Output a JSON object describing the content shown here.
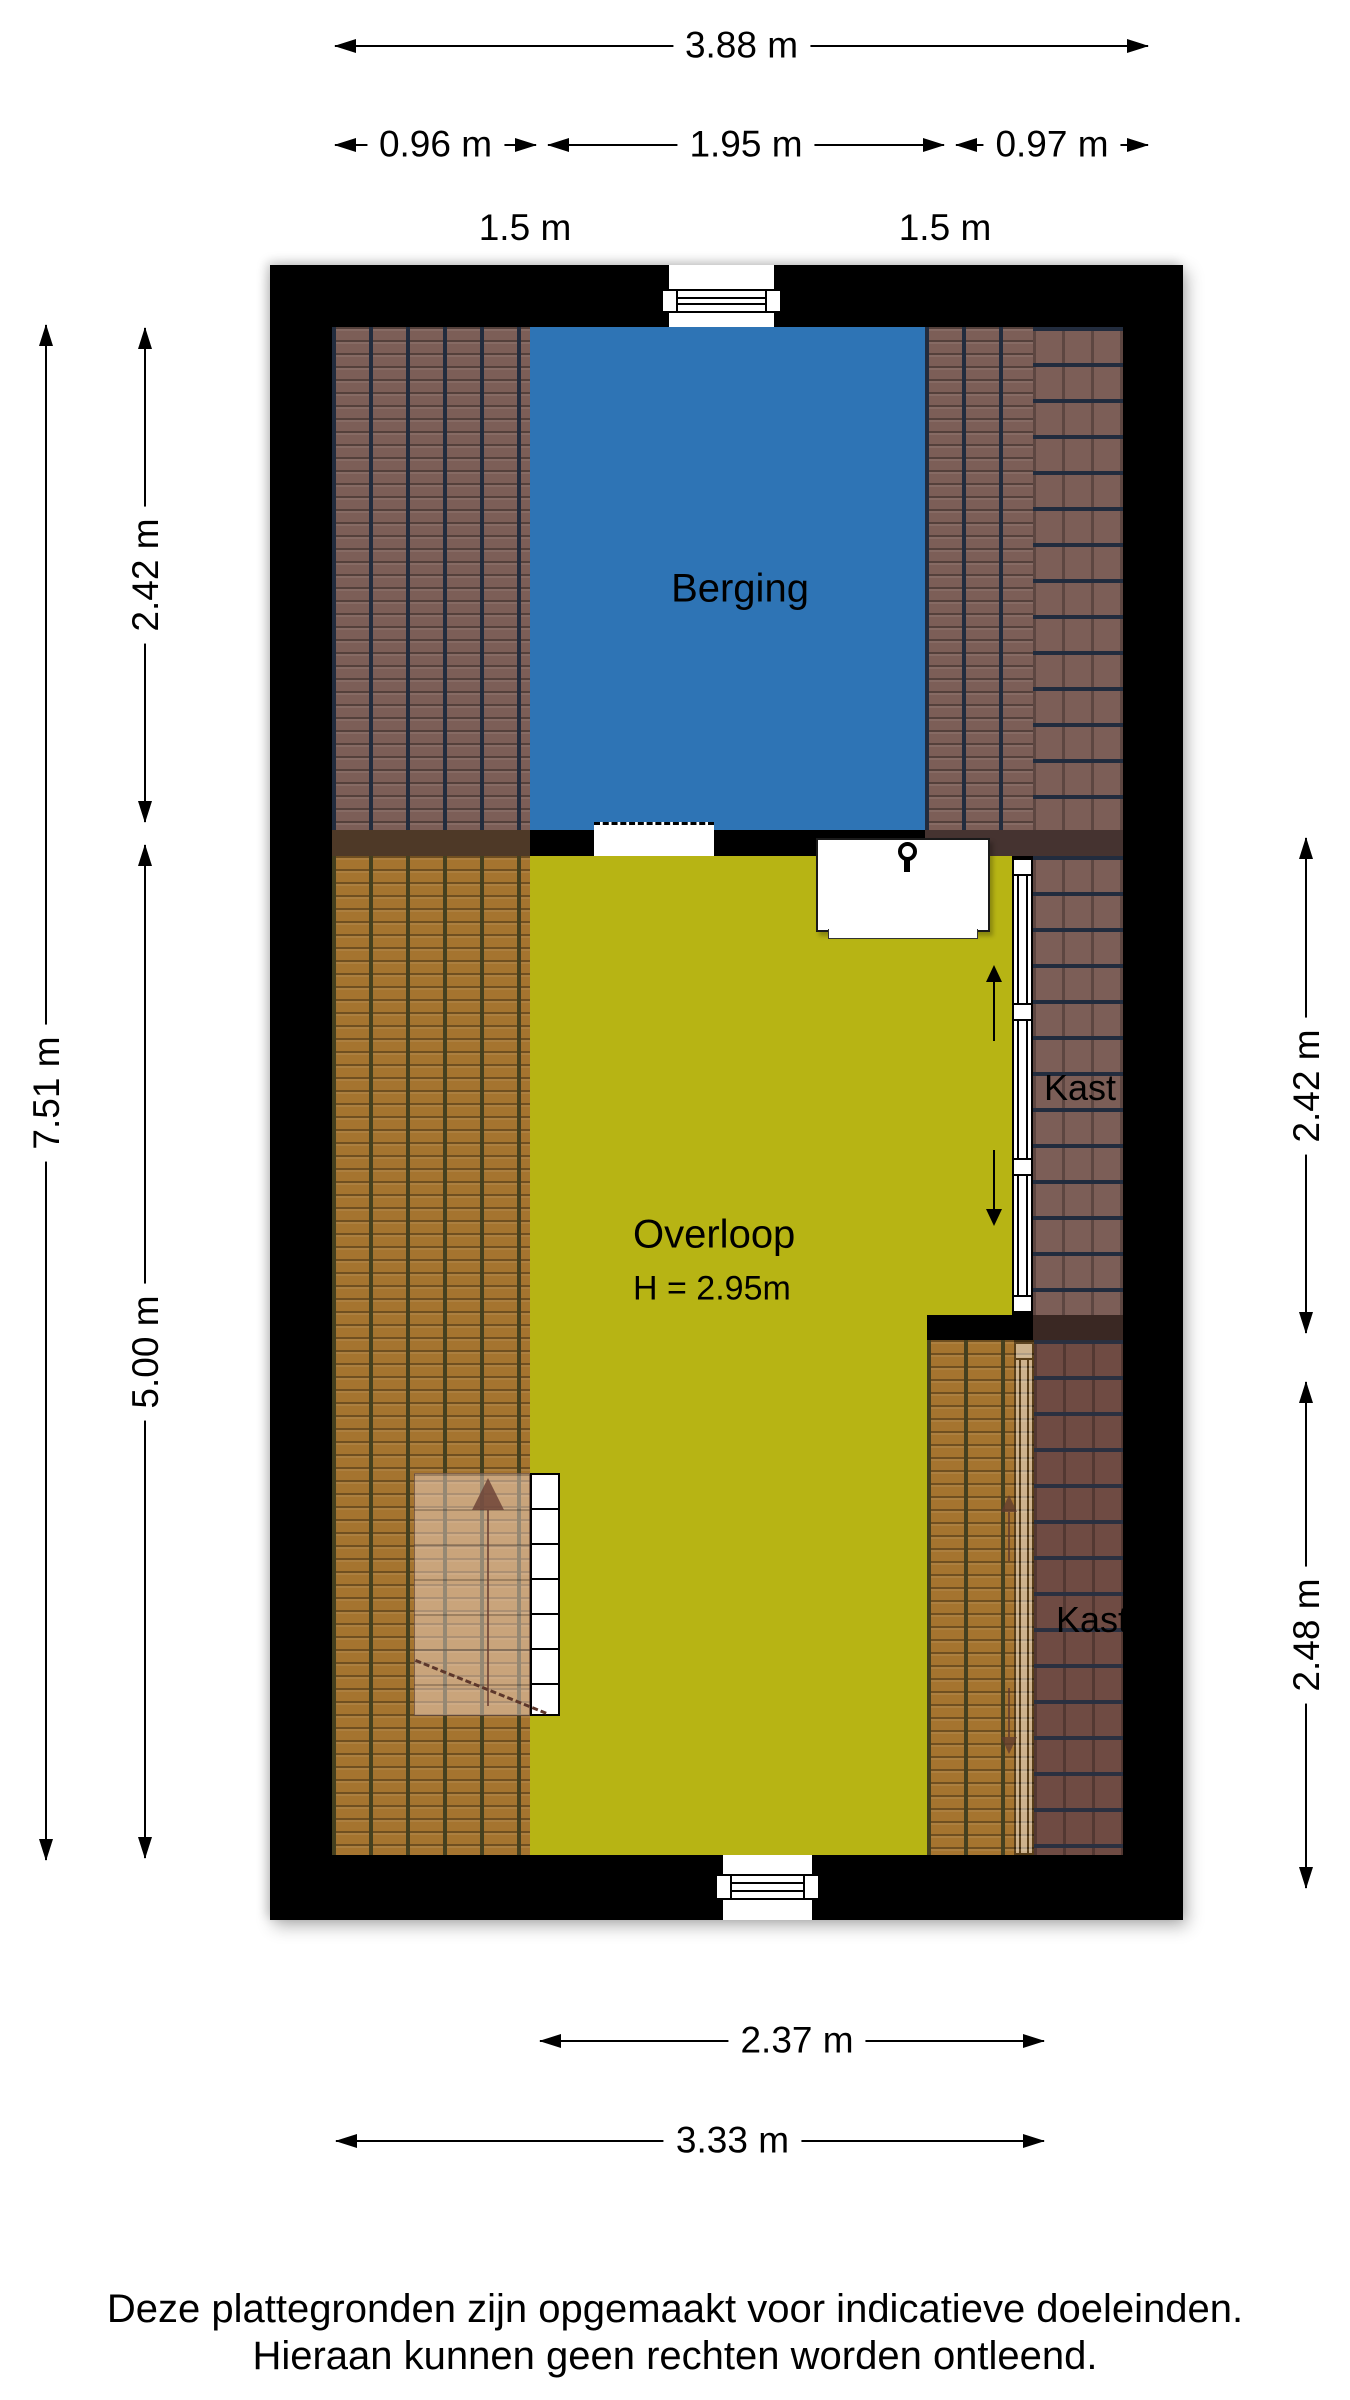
{
  "document_type": "floorplan",
  "plan": {
    "rooms": {
      "berging": {
        "label": "Berging"
      },
      "overloop": {
        "label": "Overloop",
        "height_note": "H = 2.95m"
      },
      "kast_upper": {
        "label": "Kast"
      },
      "kast_lower": {
        "label": "Kast"
      }
    }
  },
  "dimensions": {
    "top_total": "3.88 m",
    "top_left": "0.96 m",
    "top_middle": "1.95 m",
    "top_right": "0.97 m",
    "headroom_left": "1.5 m",
    "headroom_right": "1.5 m",
    "left_total": "7.51 m",
    "left_upper": "2.42 m",
    "left_lower": "5.00 m",
    "right_upper": "2.42 m",
    "right_lower": "2.48 m",
    "bottom_inner": "2.37 m",
    "bottom_total": "3.33 m"
  },
  "footer": {
    "line1": "Deze plattegronden zijn opgemaakt voor indicatieve doeleinden.",
    "line2": "Hieraan kunnen geen rechten worden ontleend."
  },
  "colors": {
    "wall": "#000000",
    "berging": "#2e74b5",
    "overloop": "#b7b414",
    "stair_arrow": "#6b4034",
    "tiles": {
      "maroon": {
        "base": "#7c5e57",
        "groove": "#222c3e"
      },
      "orange": {
        "base": "#a5742f",
        "groove": "#45401f"
      },
      "dark": {
        "base": "#6f4b43",
        "groove": "#2b3040"
      }
    }
  }
}
